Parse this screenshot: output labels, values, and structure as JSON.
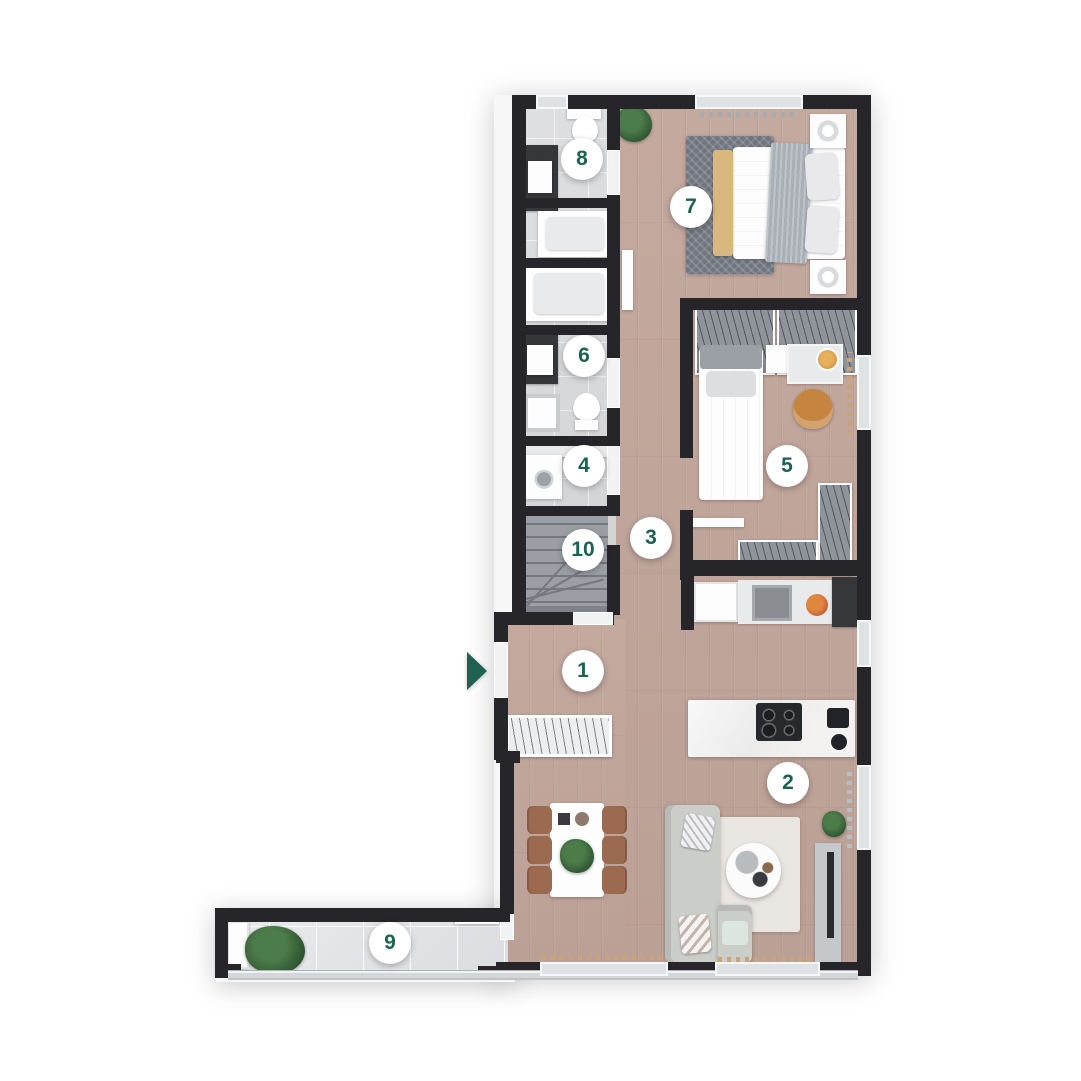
{
  "floorplan": {
    "type": "apartment-floor-plan-top-view",
    "colors": {
      "wall": "#26262a",
      "wood": "#bfa49a",
      "tile": "#d9dadc",
      "btile": "#e4e5e7",
      "badge-bg": "#ffffff",
      "badge-text": "#1b6350",
      "arrow": "#1b6350"
    },
    "markers": [
      {
        "label": "1",
        "x": 583,
        "y": 671
      },
      {
        "label": "2",
        "x": 788,
        "y": 783
      },
      {
        "label": "3",
        "x": 651,
        "y": 538
      },
      {
        "label": "4",
        "x": 584,
        "y": 466
      },
      {
        "label": "5",
        "x": 787,
        "y": 466
      },
      {
        "label": "6",
        "x": 584,
        "y": 356
      },
      {
        "label": "7",
        "x": 691,
        "y": 207
      },
      {
        "label": "8",
        "x": 582,
        "y": 159
      },
      {
        "label": "9",
        "x": 390,
        "y": 943
      },
      {
        "label": "10",
        "x": 583,
        "y": 550
      }
    ],
    "entrance_arrow": {
      "x": 467,
      "y": 652,
      "direction": "right"
    }
  }
}
